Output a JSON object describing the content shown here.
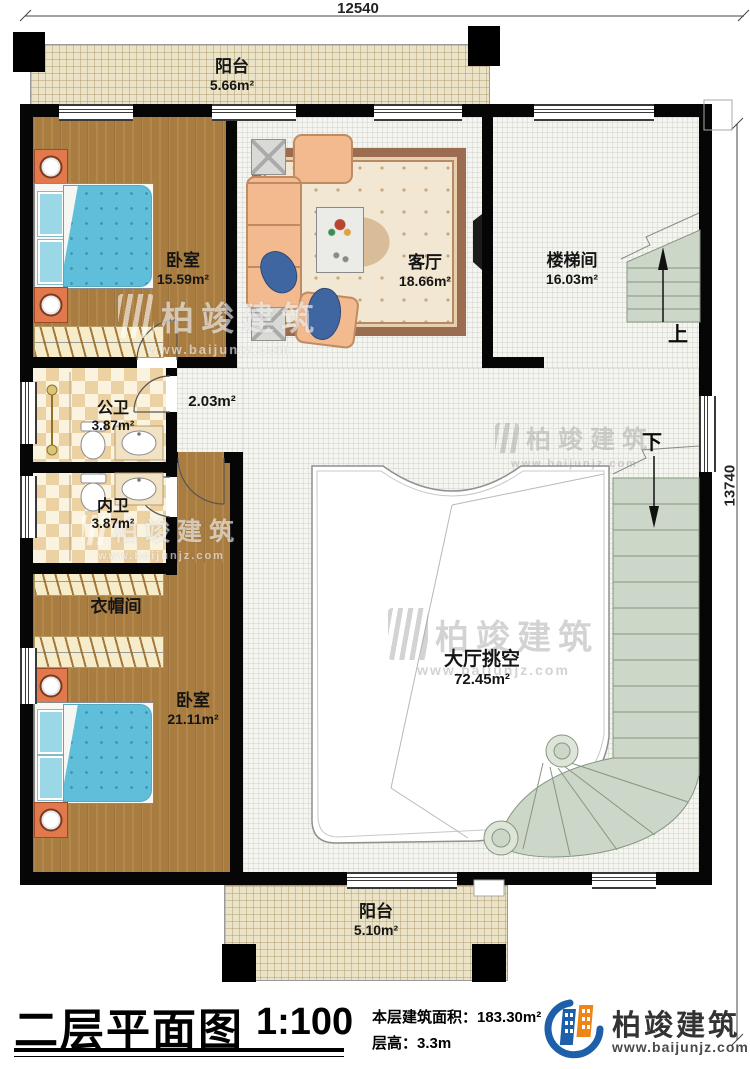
{
  "dimensions": {
    "top": "12540",
    "right": "13740"
  },
  "rooms": {
    "balcony_top": {
      "name": "阳台",
      "area": "5.66m²"
    },
    "bedroom1": {
      "name": "卧室",
      "area": "15.59m²"
    },
    "living_room": {
      "name": "客厅",
      "area": "18.66m²"
    },
    "stair_hall": {
      "name": "楼梯间",
      "area": "16.03m²"
    },
    "corridor": {
      "area": "2.03m²"
    },
    "public_bath": {
      "name": "公卫",
      "area": "3.87m²"
    },
    "inner_bath": {
      "name": "内卫",
      "area": "3.87m²"
    },
    "cloakroom": {
      "name": "衣帽间"
    },
    "bedroom2": {
      "name": "卧室",
      "area": "21.11m²"
    },
    "hall_void": {
      "name": "大厅挑空",
      "area": "72.45m²"
    },
    "balcony_bottom": {
      "name": "阳台",
      "area": "5.10m²"
    }
  },
  "stairs": {
    "up_label": "上",
    "down_label": "下"
  },
  "watermark": {
    "brand": "柏竣建筑",
    "website": "www.baijunjz.com"
  },
  "title_block": {
    "plan_title": "二层平面图",
    "scale": "1:100",
    "area_line": "本层建筑面积：183.30m²",
    "floor_height_line": "层高：3.3m",
    "brand": "柏竣建筑",
    "website": "www.baijunjz.com"
  },
  "colors": {
    "wall": "#000000",
    "wood_floor": "#a97c40",
    "tile_checker": "#ecd2a2",
    "stair": "#cdd7c9",
    "bed": "#5fbeda",
    "logo_blue": "#1d5fa9",
    "logo_orange": "#ef8418"
  }
}
